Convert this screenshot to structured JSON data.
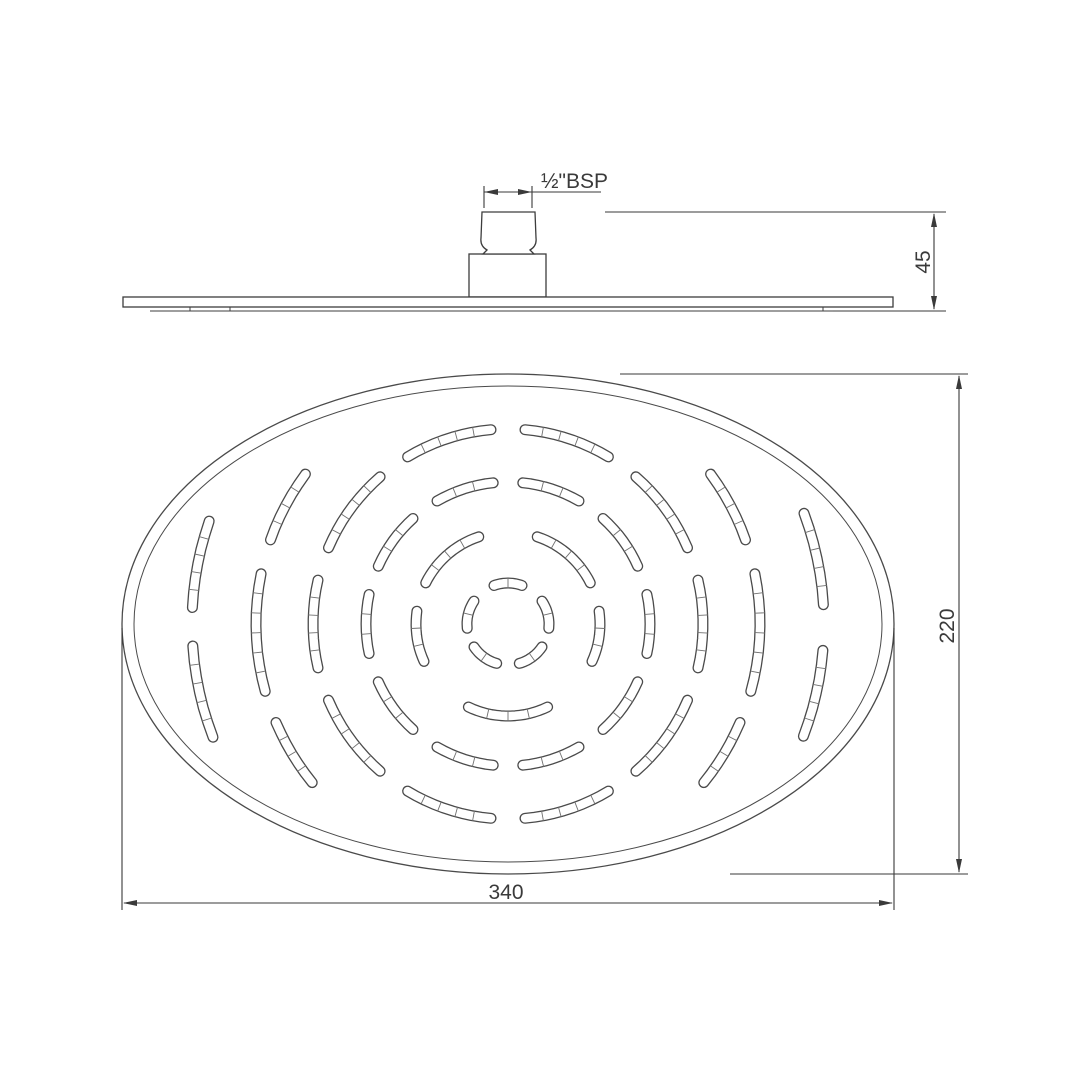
{
  "document": {
    "type": "technical drawing",
    "subject": "oval overhead shower head",
    "background_color": "#ffffff",
    "line_color": "#3d3d3d",
    "slot_outline_color": "#4a4a4a",
    "tick_color": "#707070"
  },
  "dimensions": {
    "thread_label": "½\"BSP",
    "head_height_label": "45",
    "face_height_label": "220",
    "face_width_label": "340"
  },
  "drawing": {
    "face": {
      "cx": 508,
      "cy": 624,
      "outer_rx": 386,
      "outer_ry": 250,
      "inner_rx": 374,
      "inner_ry": 238
    },
    "slot_width": 11,
    "rings": [
      {
        "r": 41,
        "segments": [
          {
            "c": 54,
            "s": 40
          },
          {
            "c": 126,
            "s": 40
          },
          {
            "c": 194,
            "s": 40
          },
          {
            "c": 270,
            "s": 40
          },
          {
            "c": 346,
            "s": 40
          }
        ]
      },
      {
        "r": 92,
        "segments": [
          {
            "c": 90,
            "s": 51
          },
          {
            "c": 172,
            "s": 32
          },
          {
            "c": 8,
            "s": 32
          },
          {
            "c": 229,
            "s": 45
          },
          {
            "c": 311,
            "s": 45
          }
        ]
      },
      {
        "r": 142,
        "segments": [
          {
            "c": 0,
            "s": 24
          },
          {
            "c": 36,
            "s": 24
          },
          {
            "c": 72,
            "s": 24
          },
          {
            "c": 108,
            "s": 24
          },
          {
            "c": 144,
            "s": 24
          },
          {
            "c": 180,
            "s": 24
          },
          {
            "c": 216,
            "s": 24
          },
          {
            "c": 252,
            "s": 24
          },
          {
            "c": 288,
            "s": 24
          },
          {
            "c": 324,
            "s": 24
          }
        ]
      },
      {
        "r": 195,
        "segments": [
          {
            "c": 0,
            "s": 26
          },
          {
            "c": 36,
            "s": 26
          },
          {
            "c": 72,
            "s": 26
          },
          {
            "c": 108,
            "s": 26
          },
          {
            "c": 144,
            "s": 26
          },
          {
            "c": 180,
            "s": 26
          },
          {
            "c": 216,
            "s": 26
          },
          {
            "c": 252,
            "s": 26
          },
          {
            "c": 288,
            "s": 26
          },
          {
            "c": 324,
            "s": 26
          }
        ]
      },
      {
        "r": 252,
        "segments": [
          {
            "c": 2,
            "s": 27
          },
          {
            "c": 31,
            "s": 16
          },
          {
            "c": 149,
            "s": 16
          },
          {
            "c": 178,
            "s": 27
          },
          {
            "c": 208,
            "s": 17
          },
          {
            "c": 332,
            "s": 17
          }
        ]
      },
      {
        "r": 316,
        "segments": [
          {
            "c": 167.5,
            "s": 17
          },
          {
            "c": 191,
            "s": 16
          },
          {
            "c": 348,
            "s": 17
          },
          {
            "c": 12.8,
            "s": 16
          }
        ]
      }
    ]
  }
}
